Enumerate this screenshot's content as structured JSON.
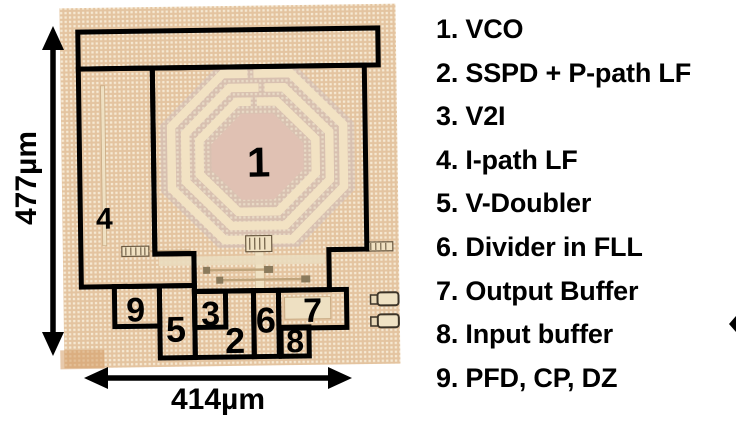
{
  "figure": {
    "dimension_labels": {
      "height": "477µm",
      "width": "414µm"
    },
    "regions": [
      {
        "num": "1",
        "legend": "1. VCO"
      },
      {
        "num": "2",
        "legend": "2. SSPD + P-path LF"
      },
      {
        "num": "3",
        "legend": "3. V2I"
      },
      {
        "num": "4",
        "legend": "4. I-path LF"
      },
      {
        "num": "5",
        "legend": "5. V-Doubler"
      },
      {
        "num": "6",
        "legend": "6. Divider in FLL"
      },
      {
        "num": "7",
        "legend": "7. Output Buffer"
      },
      {
        "num": "8",
        "legend": "8. Input buffer"
      },
      {
        "num": "9",
        "legend": "9. PFD, CP, DZ"
      }
    ],
    "colors": {
      "annotation_outline": "#000000",
      "die_base": "#e6c7a5",
      "die_dot": "#f6e9d3",
      "inductor_field": "#d8c0b0",
      "inductor_trace": "#f2e2c3",
      "inductor_center": "#e0c1b3",
      "pad_fill": "#efe2c4"
    }
  }
}
